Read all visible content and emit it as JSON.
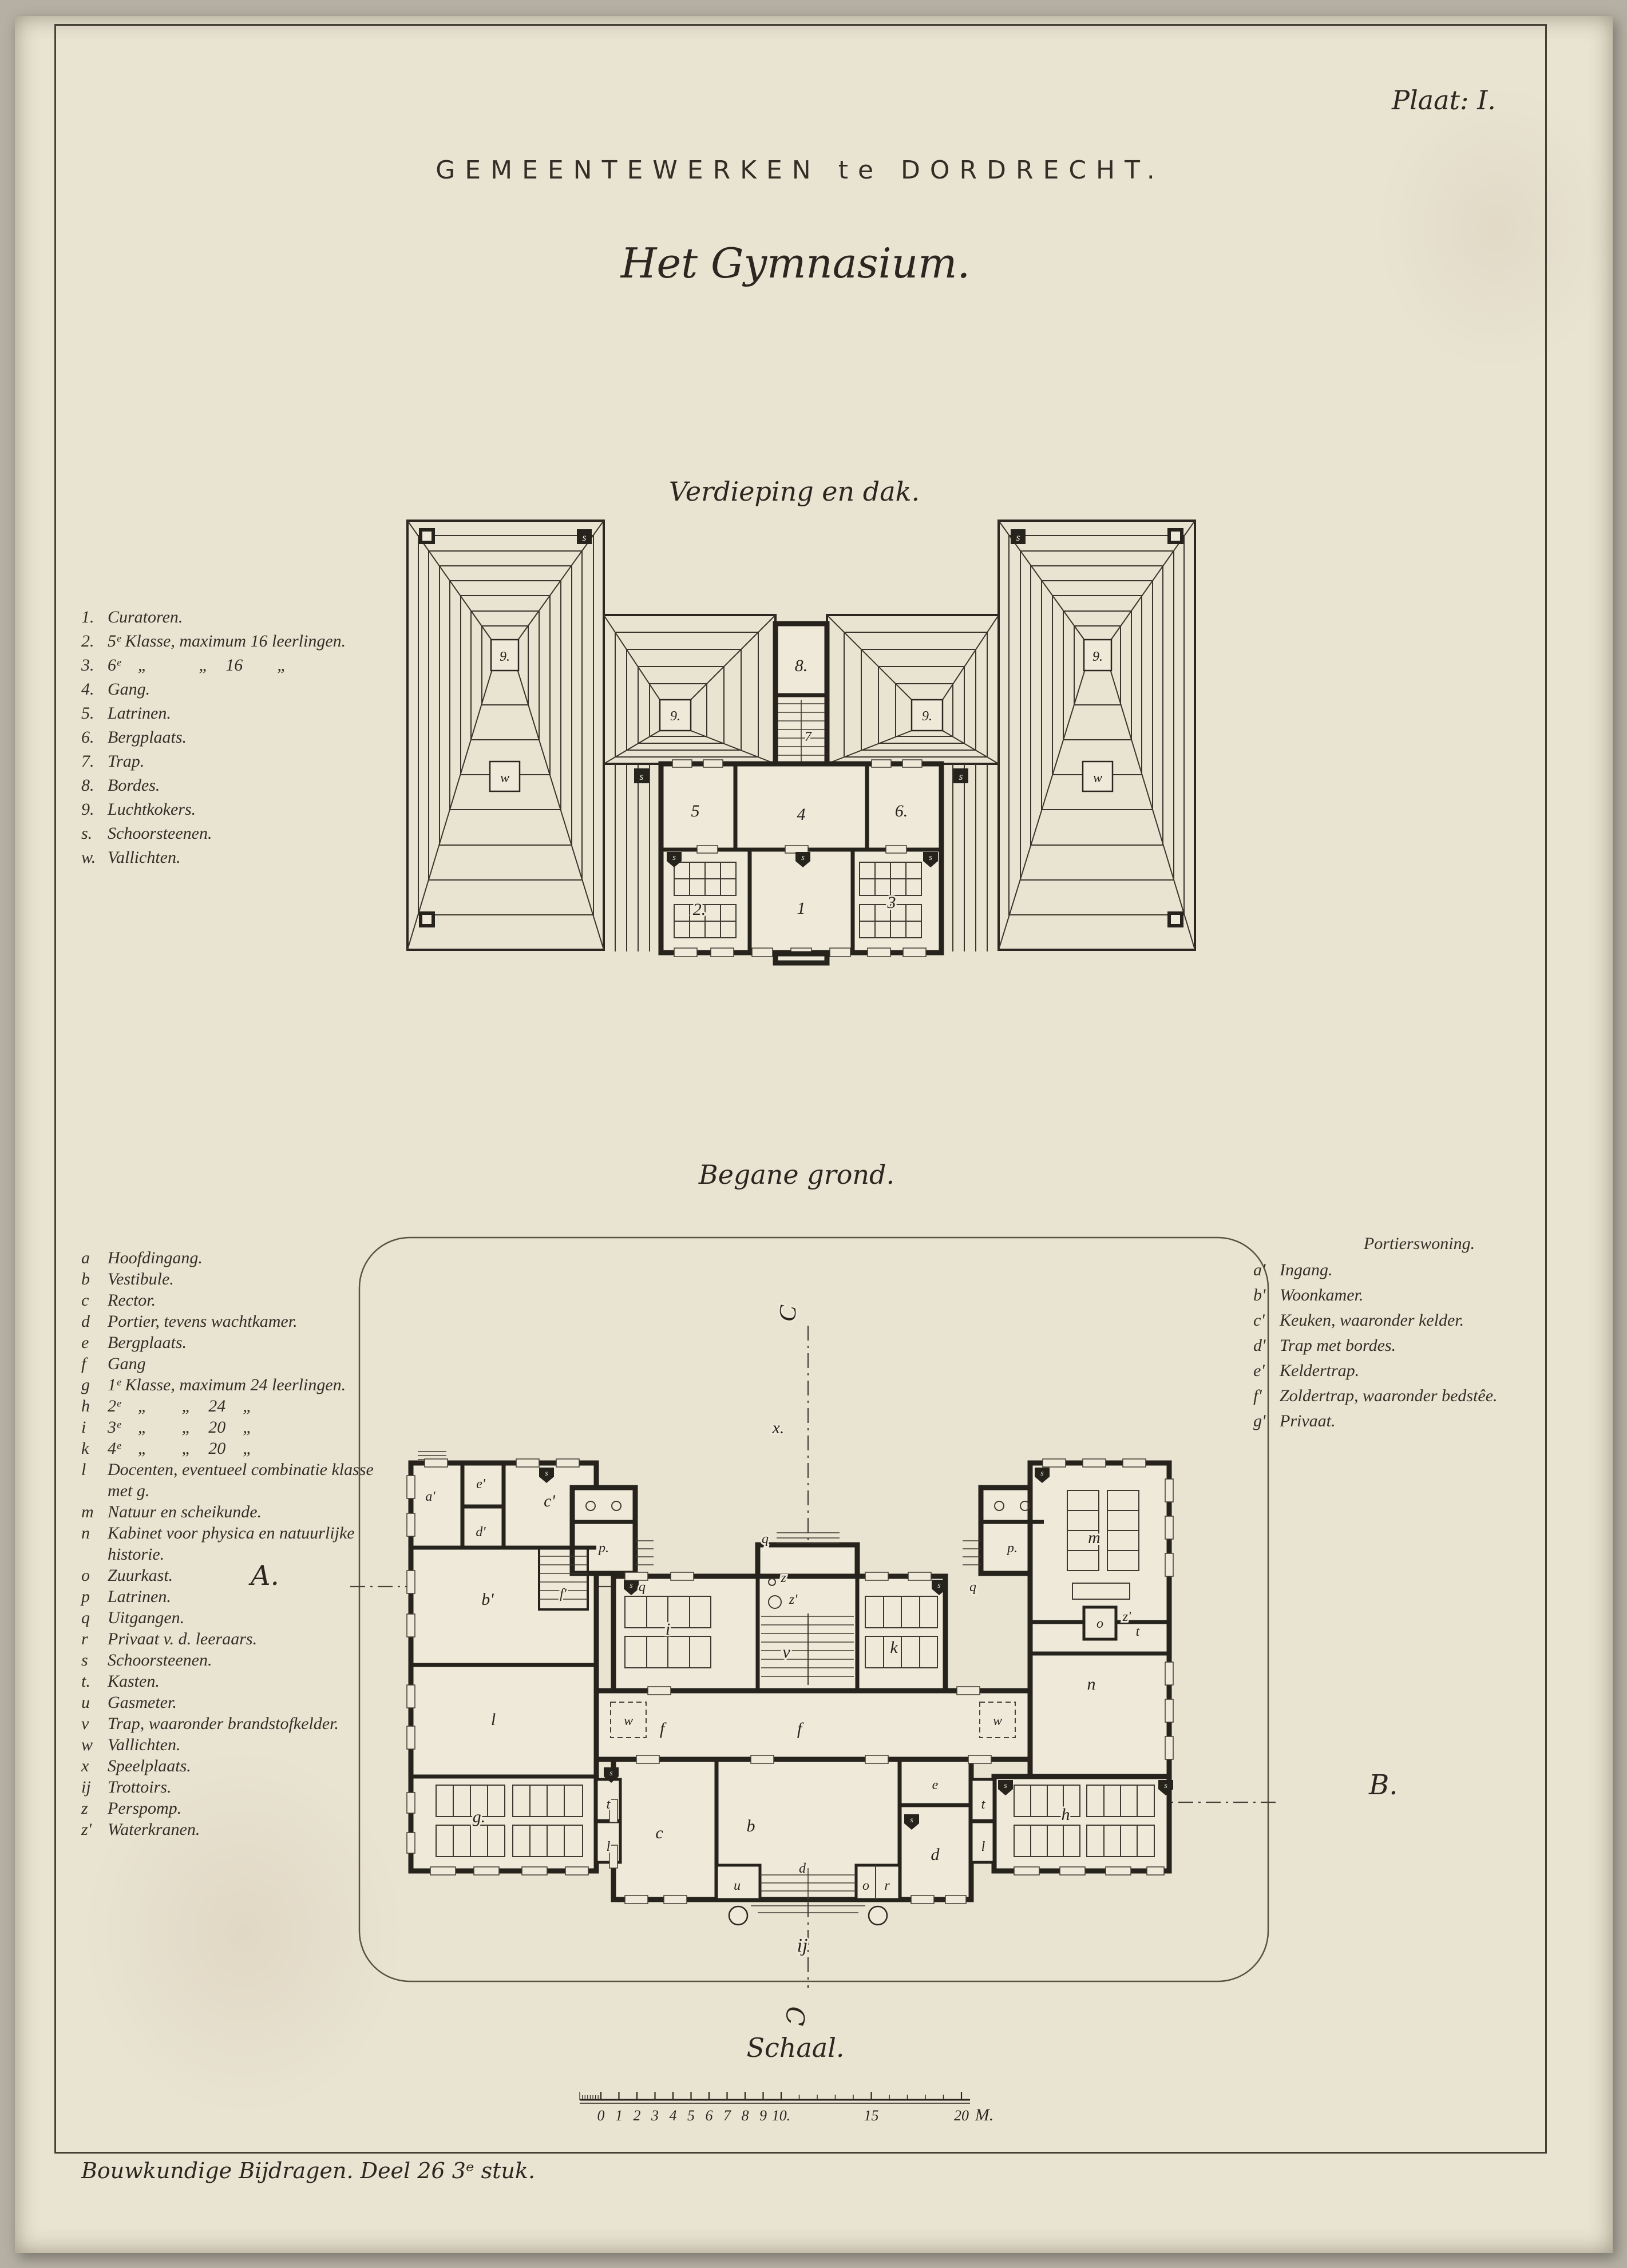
{
  "plate_label": "Plaat: I.",
  "header": {
    "department": "GEMEENTEWERKEN te DORDRECHT.",
    "title": "Het Gymnasium."
  },
  "upper_plan": {
    "title": "Verdieping en dak.",
    "legend": [
      {
        "key": "1.",
        "text": "Curatoren."
      },
      {
        "key": "2.",
        "text": "5ᵉ Klasse, maximum 16 leerlingen."
      },
      {
        "key": "3.",
        "text": "6ᵉ    „            „    16        „"
      },
      {
        "key": "4.",
        "text": "Gang."
      },
      {
        "key": "5.",
        "text": "Latrinen."
      },
      {
        "key": "6.",
        "text": "Bergplaats."
      },
      {
        "key": "7.",
        "text": "Trap."
      },
      {
        "key": "8.",
        "text": "Bordes."
      },
      {
        "key": "9.",
        "text": "Luchtkokers."
      },
      {
        "key": "s.",
        "text": "Schoorsteenen."
      },
      {
        "key": "w.",
        "text": "Vallichten."
      }
    ],
    "labels": {
      "r1": "1",
      "r2": "2.",
      "r3": "3",
      "r4": "4",
      "r5": "5",
      "r6": "6.",
      "r7": "7",
      "r8": "8.",
      "vent": "9.",
      "chimney": "s",
      "skylight": "w"
    }
  },
  "lower_plan": {
    "title": "Begane grond.",
    "legend": [
      {
        "key": "a",
        "text": "Hoofdingang."
      },
      {
        "key": "b",
        "text": "Vestibule."
      },
      {
        "key": "c",
        "text": "Rector."
      },
      {
        "key": "d",
        "text": "Portier, tevens wachtkamer."
      },
      {
        "key": "e",
        "text": "Bergplaats."
      },
      {
        "key": "f",
        "text": "Gang"
      },
      {
        "key": "g",
        "text": "1ᵉ Klasse, maximum 24 leerlingen."
      },
      {
        "key": "h",
        "text": "2ᵉ    „        „    24    „"
      },
      {
        "key": "i",
        "text": "3ᵉ    „        „    20    „"
      },
      {
        "key": "k",
        "text": "4ᵉ    „        „    20    „"
      },
      {
        "key": "l",
        "text": "Docenten, eventueel combinatie klasse met g."
      },
      {
        "key": "m",
        "text": "Natuur en scheikunde."
      },
      {
        "key": "n",
        "text": "Kabinet voor physica en natuurlijke historie."
      },
      {
        "key": "o",
        "text": "Zuurkast."
      },
      {
        "key": "p",
        "text": "Latrinen."
      },
      {
        "key": "q",
        "text": "Uitgangen."
      },
      {
        "key": "r",
        "text": "Privaat v. d. leeraars."
      },
      {
        "key": "s",
        "text": "Schoorsteenen."
      },
      {
        "key": "t.",
        "text": "Kasten."
      },
      {
        "key": "u",
        "text": "Gasmeter."
      },
      {
        "key": "v",
        "text": "Trap, waaronder brandstofkelder."
      },
      {
        "key": "w",
        "text": "Vallichten."
      },
      {
        "key": "x",
        "text": "Speelplaats."
      },
      {
        "key": "ij",
        "text": "Trottoirs."
      },
      {
        "key": "z",
        "text": "Perspomp."
      },
      {
        "key": "z'",
        "text": "Waterkranen."
      }
    ],
    "portierswoning": {
      "title": "Portierswoning.",
      "legend": [
        {
          "key": "a'",
          "text": "Ingang."
        },
        {
          "key": "b'",
          "text": "Woonkamer."
        },
        {
          "key": "c'",
          "text": "Keuken, waaronder kelder."
        },
        {
          "key": "d'",
          "text": "Trap met bordes."
        },
        {
          "key": "e'",
          "text": "Keldertrap."
        },
        {
          "key": "f'",
          "text": "Zoldertrap, waaronder bedstêe."
        },
        {
          "key": "g'",
          "text": "Privaat."
        }
      ]
    },
    "labels": {
      "a1": "a'",
      "b1": "b'",
      "c1": "c'",
      "d1": "d'",
      "e1": "e'",
      "f1": "f'",
      "b": "b",
      "c": "c",
      "d": "d",
      "e": "e",
      "f": "f",
      "g": "g.",
      "h": "h",
      "i": "i",
      "k": "k",
      "l": "l",
      "m": "m",
      "n": "n",
      "o": "o",
      "p": "p.",
      "q": "q",
      "r": "r",
      "s": "s",
      "t": "t",
      "u": "u",
      "v": "v",
      "w": "w",
      "x": "x.",
      "ij": "ij",
      "z": "z",
      "z_prime": "z'"
    },
    "section_markers": {
      "a": "A.",
      "b": "B.",
      "c": "C"
    }
  },
  "scale": {
    "title": "Schaal.",
    "ticks": [
      "0",
      "1",
      "2",
      "3",
      "4",
      "5",
      "6",
      "7",
      "8",
      "9",
      "10.",
      "15",
      "20"
    ],
    "unit": "M."
  },
  "imprint": "Bouwkundige Bijdragen. Deel 26  3ᵉ stuk."
}
